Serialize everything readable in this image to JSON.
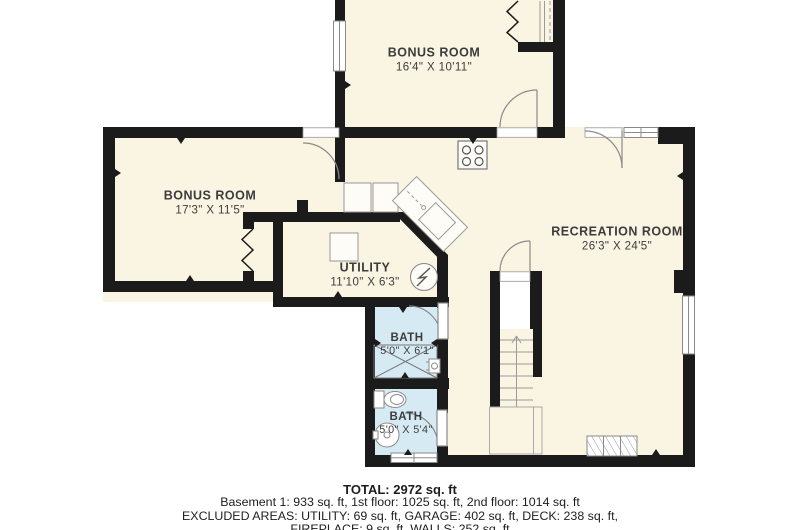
{
  "floor_plan": {
    "rooms": [
      {
        "key": "bonus-room-top",
        "name": "BONUS ROOM",
        "dims": "16'4\" X 10'11\""
      },
      {
        "key": "bonus-room-left",
        "name": "BONUS ROOM",
        "dims": "17'3\" X 11'5\""
      },
      {
        "key": "utility",
        "name": "UTILITY",
        "dims": "11'10\" X 6'3\""
      },
      {
        "key": "recreation-room",
        "name": "RECREATION ROOM",
        "dims": "26'3\" X 24'5\""
      },
      {
        "key": "bath-upper",
        "name": "BATH",
        "dims": "5'0\" X 6'1\""
      },
      {
        "key": "bath-lower",
        "name": "BATH",
        "dims": "5'0\" X 5'4\""
      }
    ],
    "summary": {
      "total": "TOTAL: 2972 sq. ft",
      "floors": "Basement 1: 933 sq. ft, 1st floor: 1025 sq. ft, 2nd floor: 1014 sq. ft",
      "excluded_1": "EXCLUDED AREAS: UTILITY: 69 sq. ft, GARAGE: 402 sq. ft, DECK: 238 sq. ft,",
      "excluded_2": "FIREPLACE: 9 sq. ft, WALLS: 252 sq. ft"
    },
    "colors": {
      "wall": "#1b1b1b",
      "floor": "#faf4e3",
      "bath_floor": "#d6eaf4",
      "background": "#ffffff",
      "fixture_line": "#8a8a8a",
      "label_text": "#3c3c3c"
    }
  }
}
